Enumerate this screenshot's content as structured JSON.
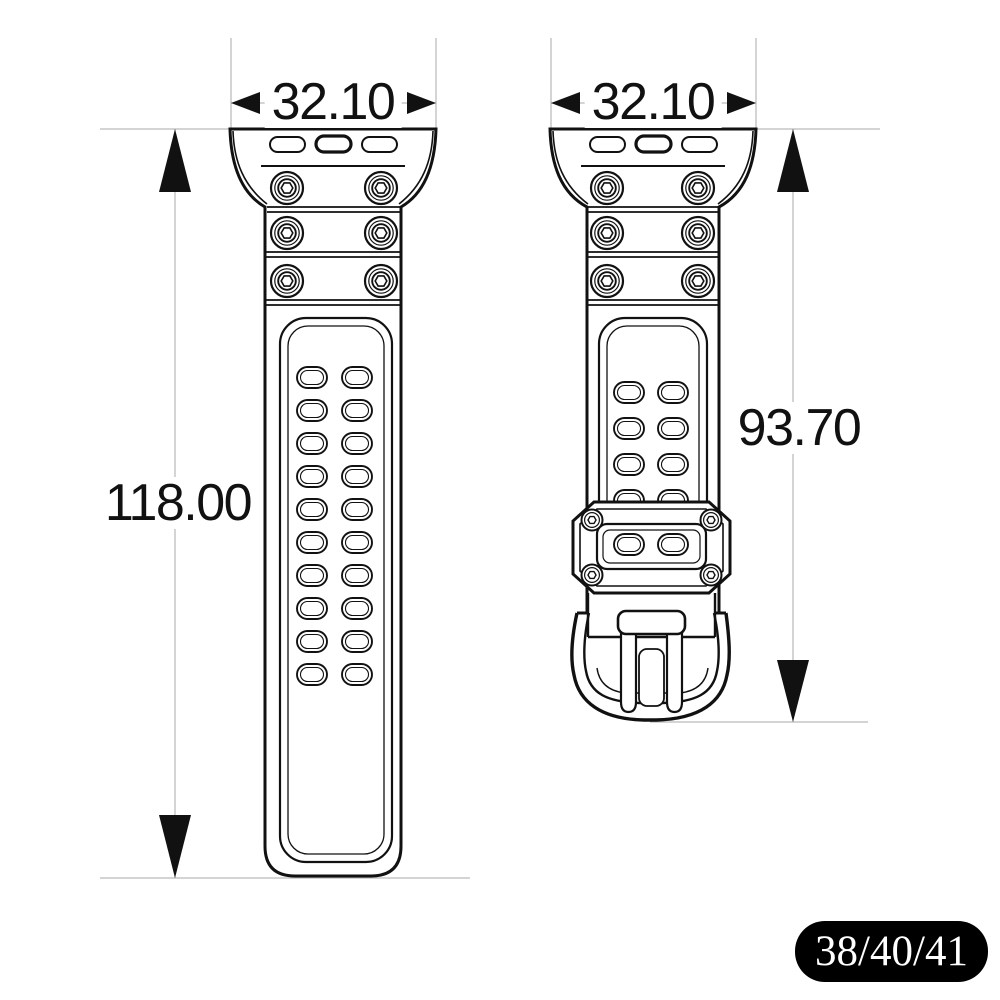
{
  "diagram": {
    "subject": "watch band technical dimension drawing, two views",
    "views": [
      {
        "id": "side",
        "width_label": "32.10",
        "length_label": "118.00"
      },
      {
        "id": "buckle",
        "width_label": "32.10",
        "length_label": "93.70"
      }
    ],
    "badge": {
      "label": "38/40/41"
    }
  },
  "colors": {
    "line": "#111111",
    "dimension_line": "#a9a9a9",
    "badge_bg": "#000000",
    "badge_fg": "#ffffff",
    "background": "#ffffff"
  }
}
